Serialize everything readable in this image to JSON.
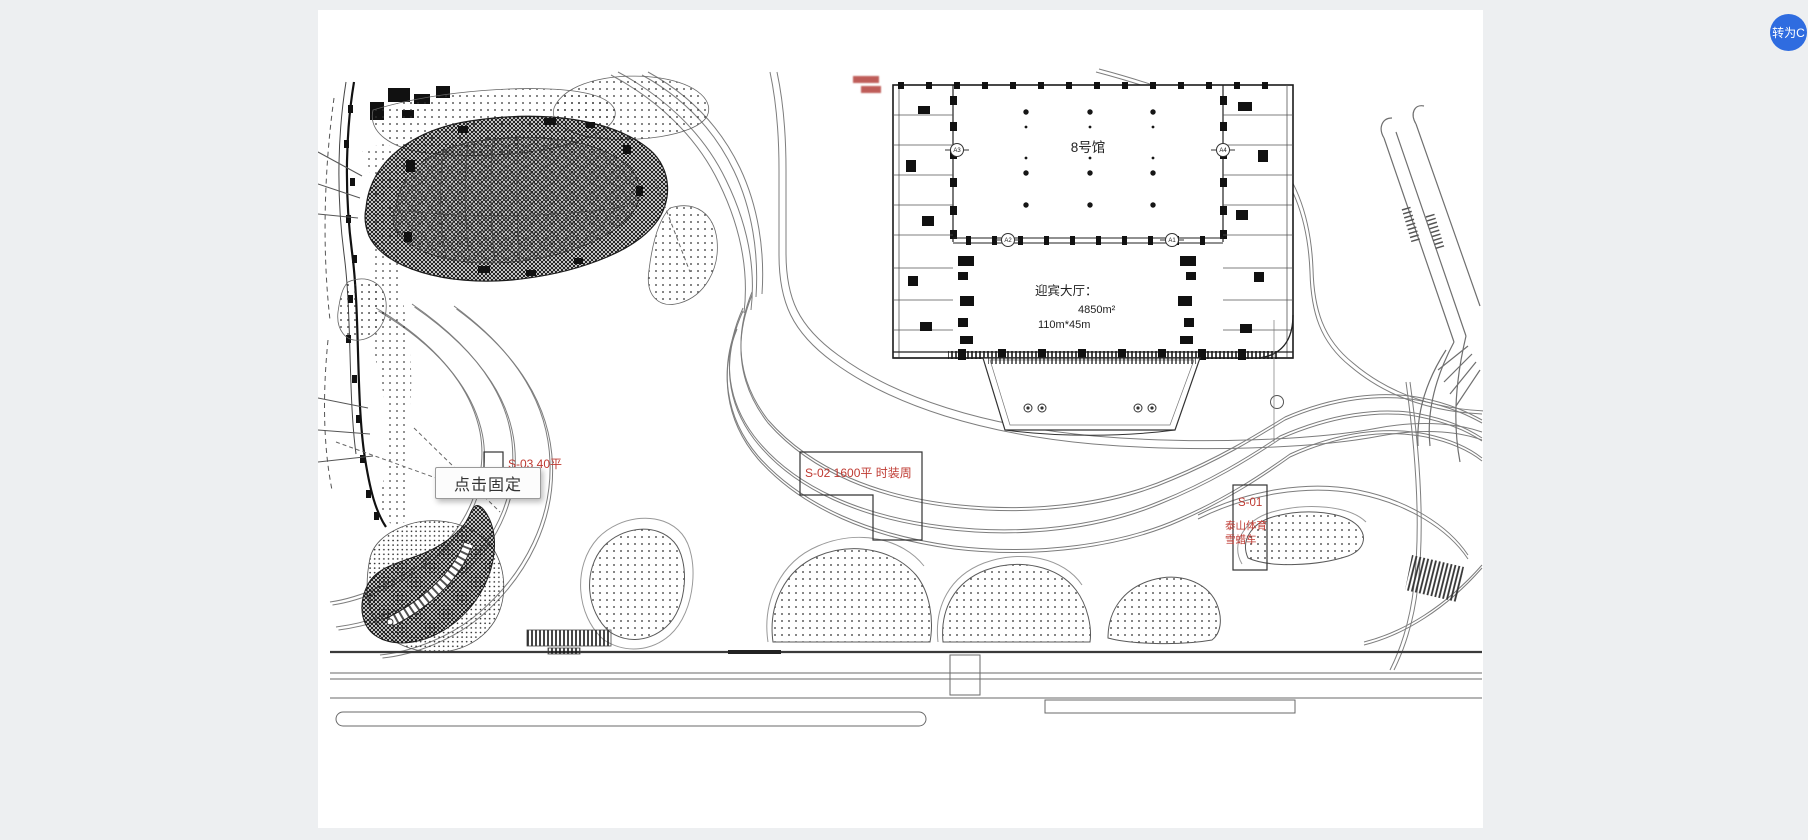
{
  "page": {
    "background": "#edeff1",
    "canvas_background": "#ffffff"
  },
  "floating_button": {
    "label": "转为C",
    "color": "#2f6ce0"
  },
  "tooltip": {
    "label": "点击固定"
  },
  "building": {
    "hall_label": "8号馆",
    "lobby_title": "迎宾大厅：",
    "lobby_area": "4850m²",
    "lobby_dimensions": "110m*45m",
    "axis_bubbles": {
      "top_left": "A3",
      "top_right": "A4",
      "mid_left": "A2",
      "mid_right": "A1"
    }
  },
  "booths": [
    {
      "code": "S-03",
      "line1": "S-03  40平",
      "line2": "京东"
    },
    {
      "code": "S-02",
      "line1": "S-02  1600平   时装周"
    },
    {
      "code": "S-01",
      "line1": "S-01",
      "line2": "泰山体育",
      "line3": "雪蜡车"
    }
  ],
  "colors": {
    "annotation_red": "#bf3a32",
    "drawing_line": "#4a4a4a"
  }
}
